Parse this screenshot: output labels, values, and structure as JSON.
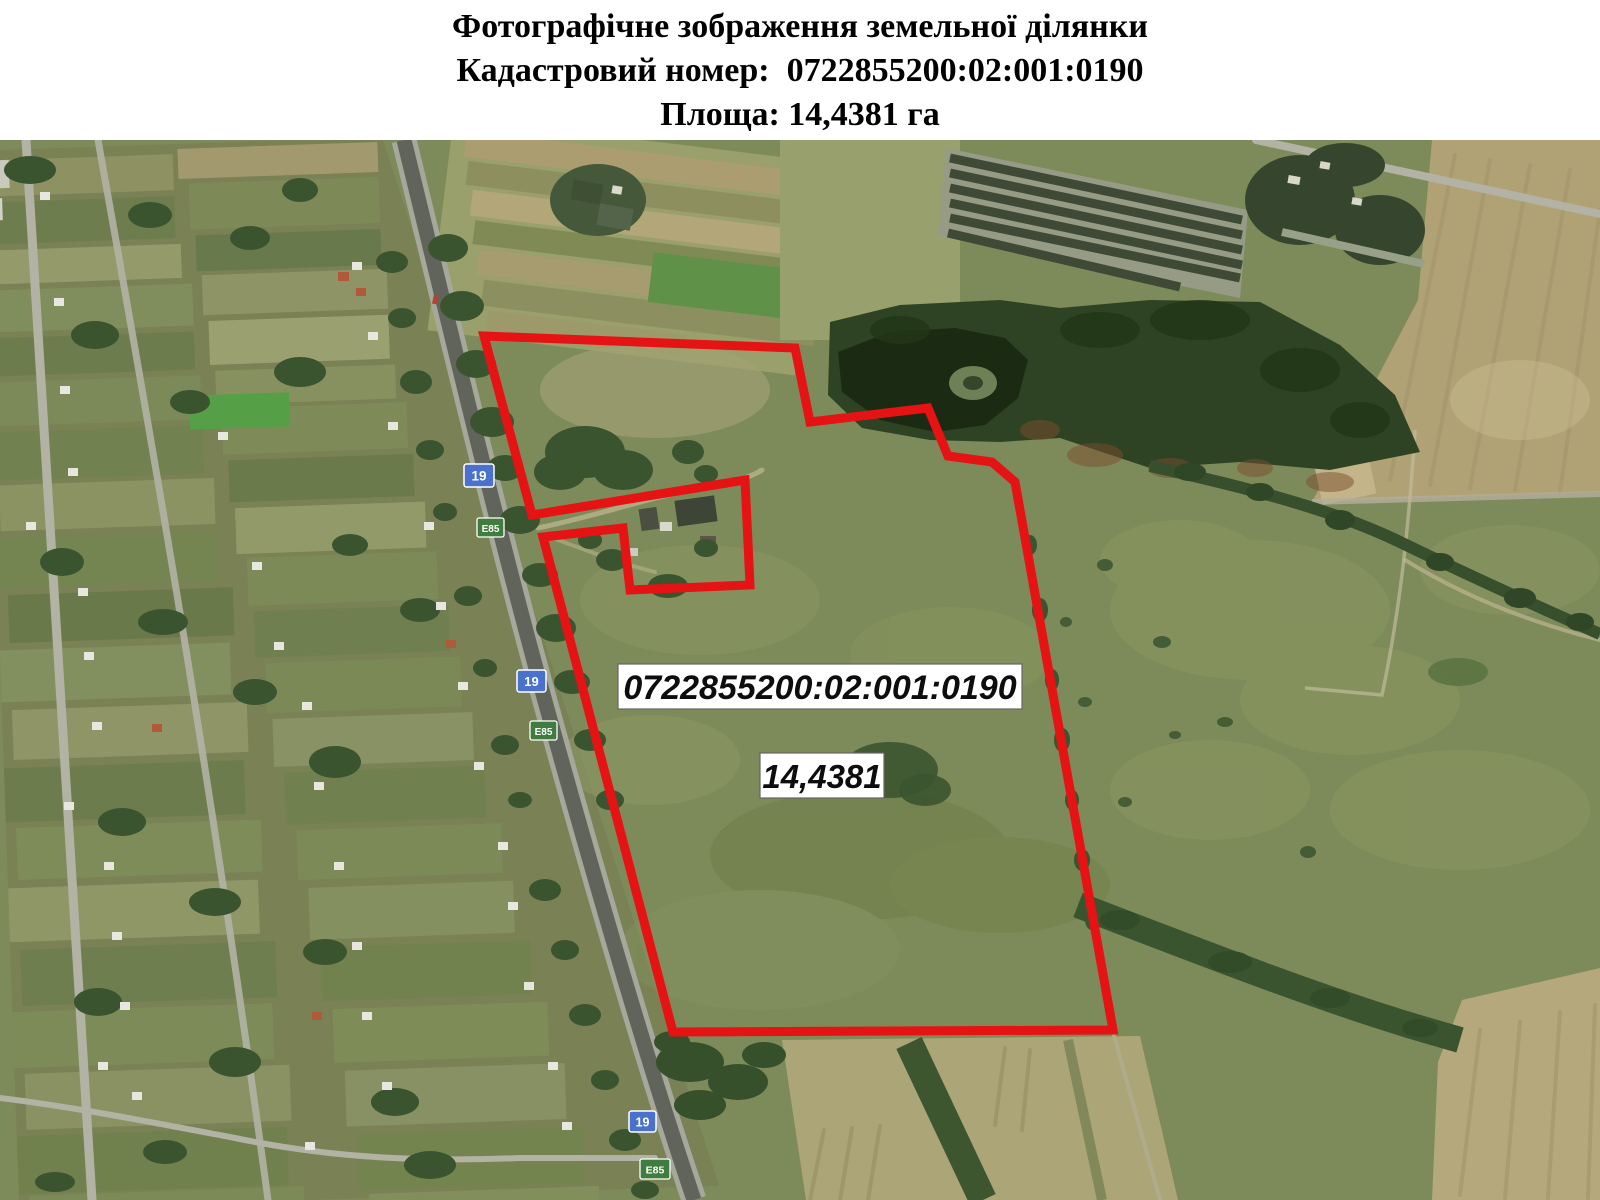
{
  "header": {
    "line1": "Фотографічне зображення земельної ділянки",
    "line2": "Кадастровий номер:  0722855200:02:001:0190",
    "line3": "Площа: 14,4381 га"
  },
  "map": {
    "parcel_number_label": "0722855200:02:001:0190",
    "area_label": "14,4381",
    "signs": {
      "national_road": "19",
      "european_route": "E85"
    },
    "colors": {
      "boundary_red": "#e51313",
      "label_bg": "#ffffff",
      "label_border": "#666666",
      "label_text": "#0d0d0d",
      "sign_blue": "#4a72cc",
      "sign_green": "#3f7d3f",
      "field_green": "#7d8a59"
    }
  }
}
